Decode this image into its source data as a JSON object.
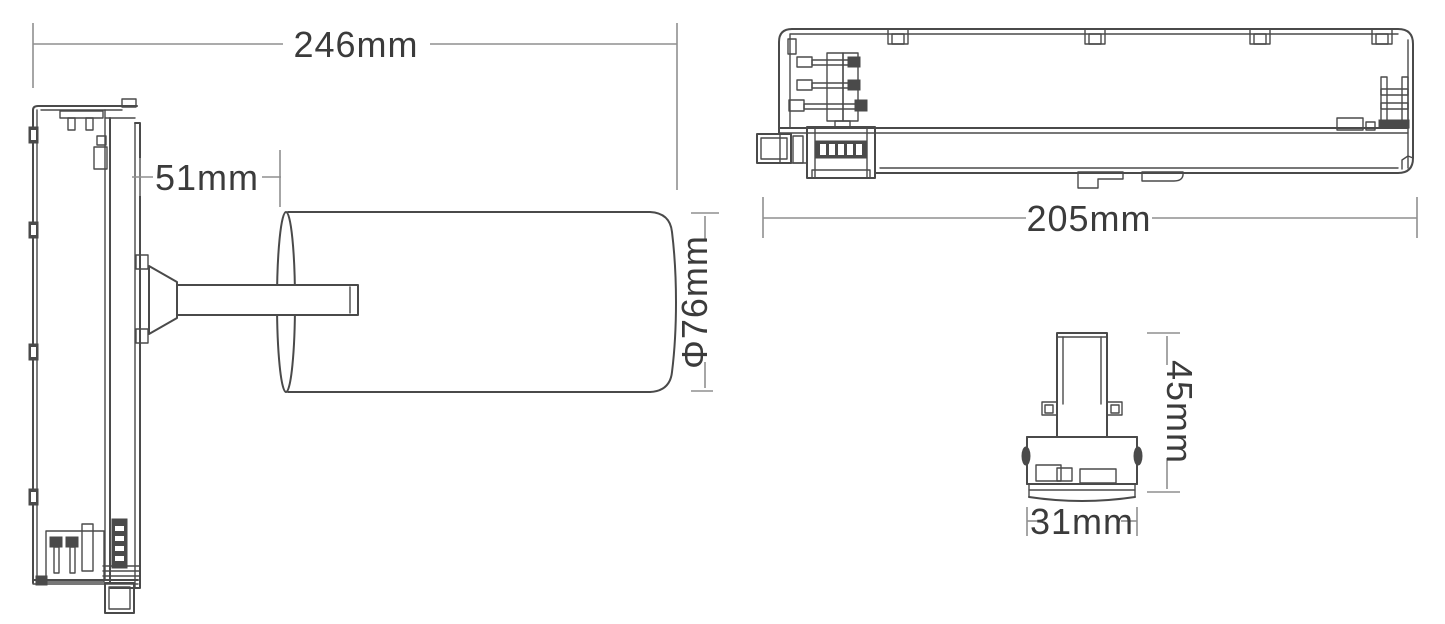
{
  "diagram": {
    "type": "technical-dimension-drawing",
    "subject": "LED track light fixture with cylindrical lamp head and track adapter",
    "colors": {
      "background": "#ffffff",
      "part_line": "#4a4a4a",
      "dimension_line": "#8f8f8f",
      "dimension_text": "#3b3b3b"
    },
    "side_view": {
      "overall_length": "246mm",
      "head_offset": "51mm",
      "head_diameter": "Φ76mm"
    },
    "top_view": {
      "body_length": "205mm"
    },
    "end_view": {
      "height": "45mm",
      "width": "31mm"
    }
  }
}
